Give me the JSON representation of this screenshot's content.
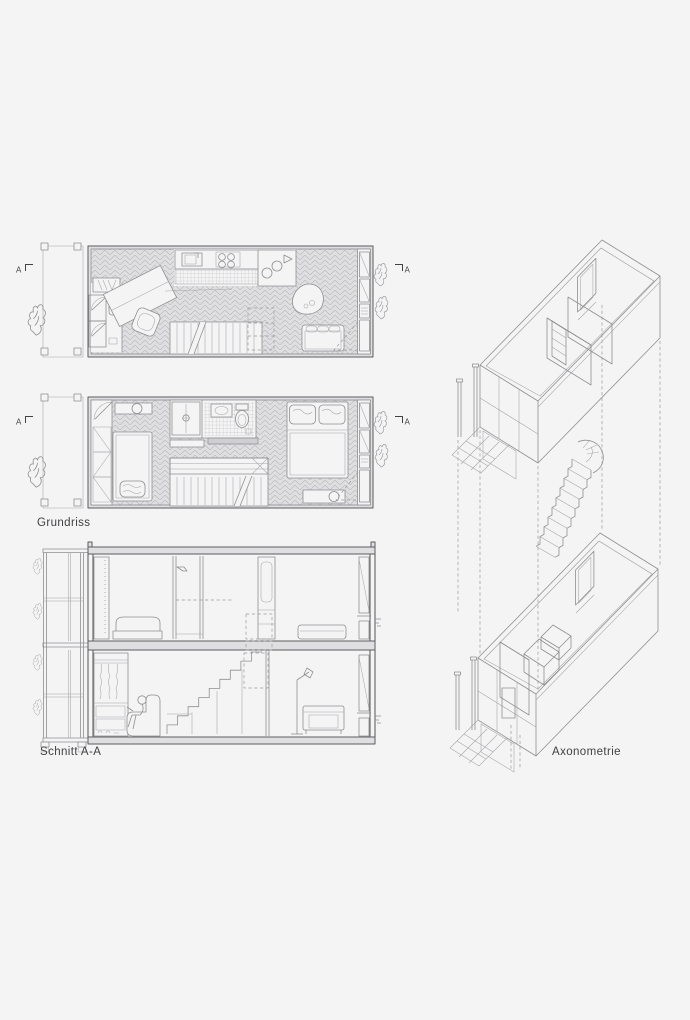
{
  "canvas": {
    "width": 690,
    "height": 1020,
    "background": "#f4f4f5"
  },
  "palette": {
    "line": "#8f8f91",
    "line_dark": "#5c5c5e",
    "line_light": "#b7b7ba",
    "wall_fill": "#dfdfe1",
    "label_text": "#414144"
  },
  "labels": {
    "plan": "Grundriss",
    "section": "Schnitt A-A",
    "axonometric": "Axonometrie"
  },
  "section_markers": {
    "letter": "A"
  }
}
